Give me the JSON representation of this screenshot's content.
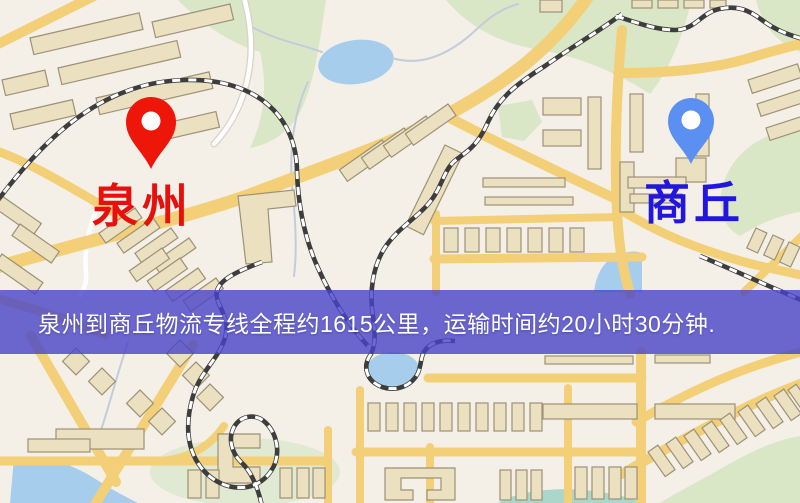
{
  "banner": {
    "text": "泉州到商丘物流专线全程约1615公里，运输时间约20小时30分钟.",
    "bg_color": "rgba(73,68,200,0.8)",
    "text_color": "#ffffff"
  },
  "markers": {
    "origin": {
      "name": "泉州",
      "pin_color": "#ee1609",
      "label_color": "#e8100c"
    },
    "destination": {
      "name": "商丘",
      "pin_color": "#5b8ff2",
      "label_color": "#2016dd"
    }
  },
  "map": {
    "colors": {
      "background": "#f4efe7",
      "green": "#d9e7c6",
      "green-pale": "#e0e9d2",
      "water": "#a6cdec",
      "teal": "#abd6c9",
      "road": "#f3d077",
      "road-white": "#ffffff",
      "building": "#ebe1c1",
      "building-stroke": "#9d9176",
      "railway": "#3d3d3d",
      "stream": "#c2cddc"
    }
  }
}
